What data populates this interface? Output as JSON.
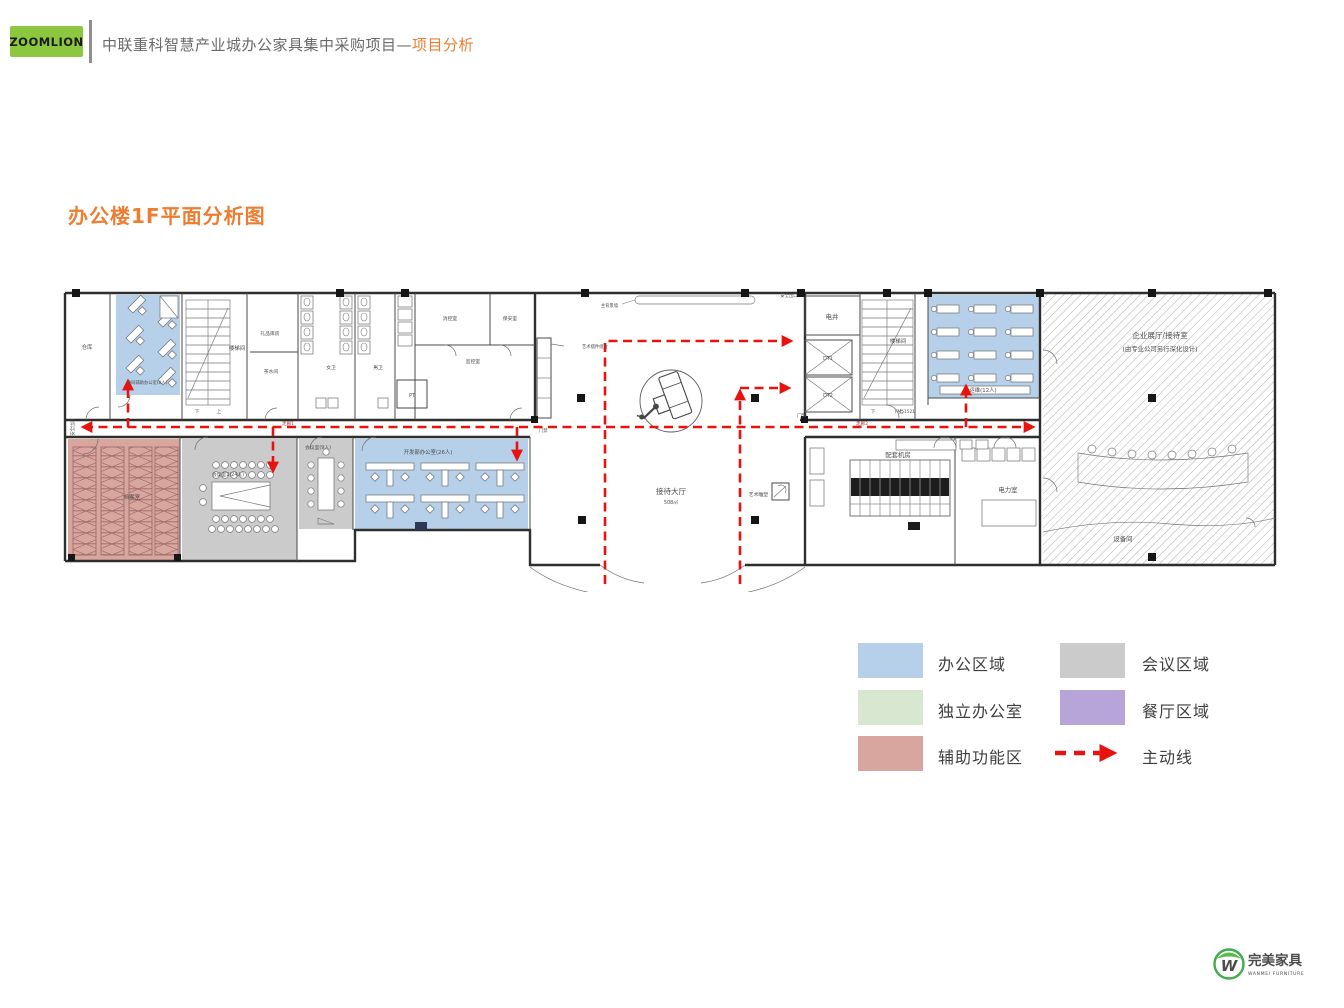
{
  "header": {
    "logo_text": "ZOOMLION",
    "title": "中联重科智慧产业城办公家具集中采购项目—",
    "title_accent": "项目分析"
  },
  "page_title": "办公楼1F平面分析图",
  "colors": {
    "accent_orange": "#ed7d31",
    "brand_green": "#8dc63f",
    "route_red": "#e8120e",
    "office_blue": "#b6d0e9",
    "meeting_gray": "#cbcbcb",
    "independent_green": "#d8e8d0",
    "dining_purple": "#b7a4d8",
    "auxiliary_pink": "#d9a59f"
  },
  "plan": {
    "labels": {
      "warehouse": "仓库",
      "collab_office": "协同辅助办公室(8人)",
      "stair_left": "楼梯间",
      "gift_store": "礼品库房",
      "pantry": "茶水间",
      "women_wc": "女卫",
      "men_wc": "男卫",
      "pt_room": "PT",
      "fire_control": "消控室",
      "security_room": "保安室",
      "monitor_room": "监控室",
      "art_display": "艺术摆件组合",
      "main_backdrop": "主背景墙",
      "safety_exit_top": "安全出口",
      "reception_hall": "接待大厅",
      "reception_area": "508㎡",
      "elec_shaft": "电井",
      "dt1": "DT1",
      "dt2": "DT2",
      "door_access": "门禁",
      "stair_right": "楼梯间",
      "door_code": "FM51521",
      "ops_office": "运维(12人)",
      "exhibition_line1": "企业展厅/接待室",
      "exhibition_line2": "(由专业公司另行深化设计)",
      "equipment_room": "设备间",
      "archive_room": "档案室",
      "meeting_24": "会议室2(24人)",
      "meeting_9": "会议室(9人)",
      "dev_office": "开发部办公室(26人)",
      "machine_room": "配套机房",
      "power_room": "电力室",
      "art_sculpture": "艺术雕塑",
      "safety_exit_left": "安全出口",
      "corridor_1": "走廊1",
      "corridor_2": "走廊2",
      "stair_up": "上",
      "stair_down": "下"
    }
  },
  "legend": {
    "items": [
      {
        "label": "办公区域"
      },
      {
        "label": "会议区域"
      },
      {
        "label": "独立办公室"
      },
      {
        "label": "餐厅区域"
      },
      {
        "label": "辅助功能区"
      },
      {
        "label": "主动线"
      }
    ]
  },
  "footer_logo": {
    "monogram": "W",
    "name": "完美家具",
    "subtitle": "WANMEI FURNITURE"
  }
}
